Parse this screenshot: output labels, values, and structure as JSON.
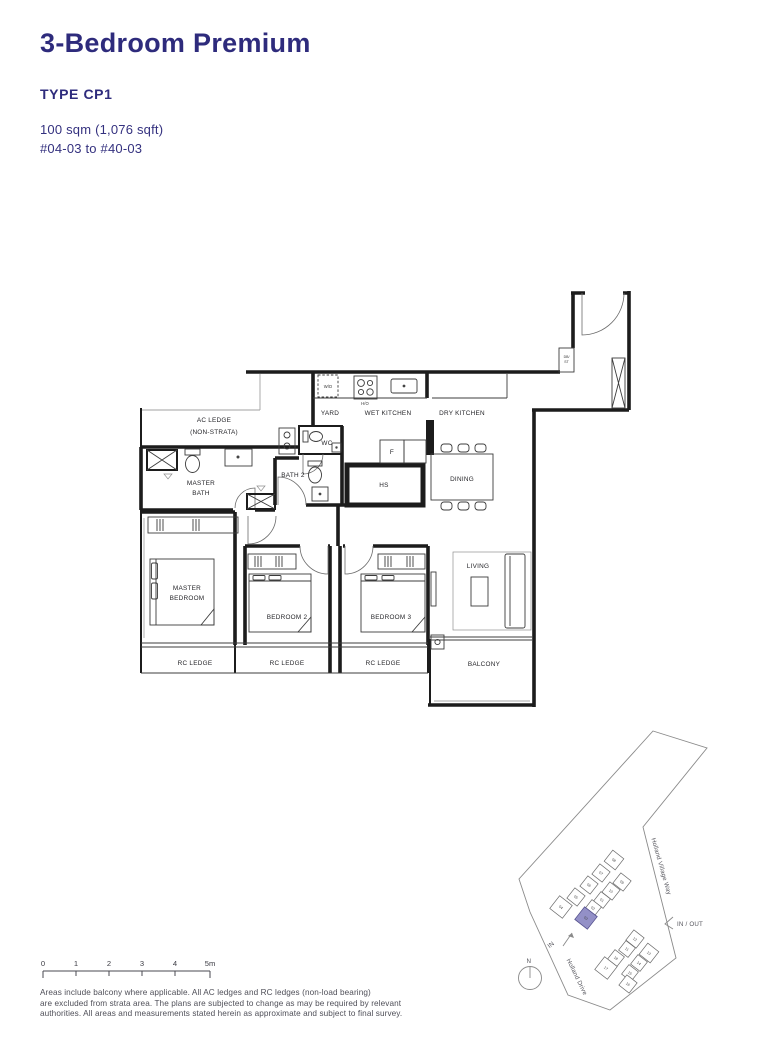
{
  "header": {
    "title": "3-Bedroom Premium",
    "type": "TYPE CP1",
    "area": "100 sqm (1,076 sqft)",
    "stacks": "#04-03 to #40-03"
  },
  "colors": {
    "accent": "#2e2b7c",
    "site_highlight": "#9390c7"
  },
  "floorplan": {
    "labels": {
      "ac_ledge_1": "AC LEDGE",
      "ac_ledge_2": "(NON-STRATA)",
      "yard": "YARD",
      "wet_kitchen": "WET KITCHEN",
      "dry_kitchen": "DRY KITCHEN",
      "wd": "W/D",
      "ho": "H/O",
      "fridge": "F",
      "db_1": "DB/",
      "db_2": "ST",
      "wc": "WC",
      "bath2": "BATH 2",
      "master_bath_1": "MASTER",
      "master_bath_2": "BATH",
      "hs": "HS",
      "dining": "DINING",
      "living": "LIVING",
      "balcony": "BALCONY",
      "master_bedroom_1": "MASTER",
      "master_bedroom_2": "BEDROOM",
      "bedroom2": "BEDROOM 2",
      "bedroom3": "BEDROOM 3",
      "rc_ledge": "RC LEDGE"
    }
  },
  "site_plan": {
    "road_right": "Holland Village Way",
    "road_left": "Holland Drive",
    "in_out": "IN / OUT",
    "in": "IN",
    "north": "N",
    "highlighted_stack": "03",
    "upper_stacks": [
      "08",
      "07",
      "06",
      "05",
      "04",
      "09",
      "10",
      "01",
      "02",
      "03"
    ],
    "lower_stacks": [
      "12",
      "11",
      "13",
      "18",
      "14",
      "17",
      "15",
      "16"
    ]
  },
  "scale_bar": {
    "ticks": [
      "0",
      "1",
      "2",
      "3",
      "4",
      "5m"
    ]
  },
  "disclaimer": {
    "line1": "Areas include balcony where applicable. All AC ledges and RC ledges (non-load bearing)",
    "line2": "are excluded from strata area. The plans are subjected to change as may be required by relevant",
    "line3": "authorities. All areas and measurements stated herein as approximate and subject to final survey."
  }
}
